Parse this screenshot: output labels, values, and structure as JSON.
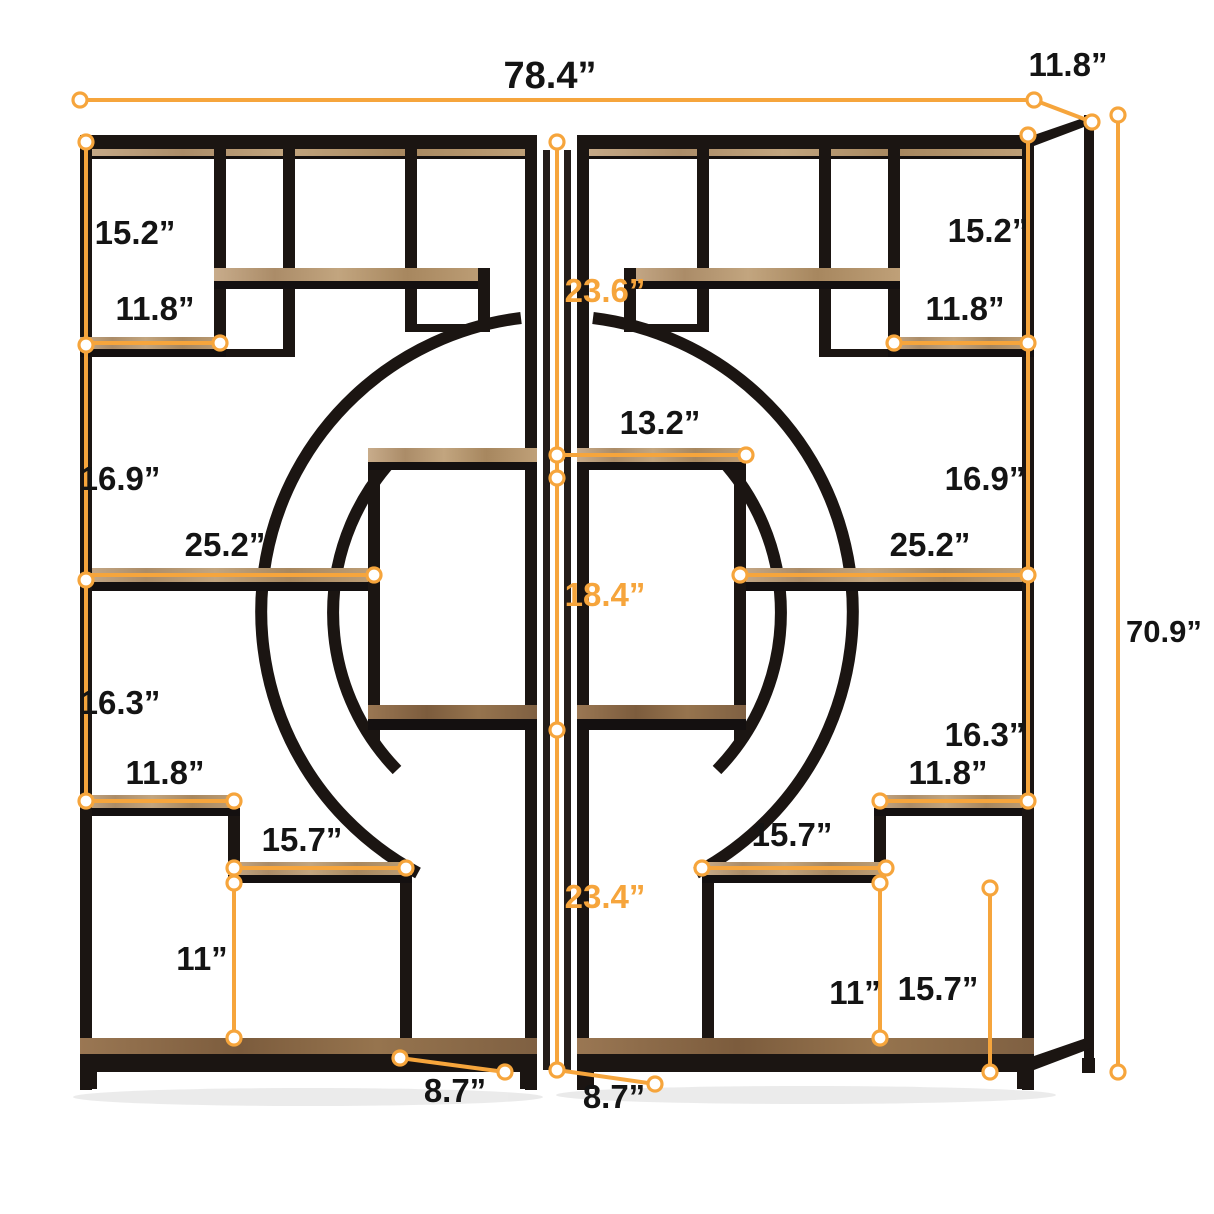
{
  "diagram": {
    "kind": "furniture-dimension-diagram",
    "subject": "double etagere bookshelf with circular arch shelves",
    "background": "#ffffff"
  },
  "colors": {
    "dimension_line": "#F6A53C",
    "dimension_label": "#141414",
    "dimension_label_accent": "#F6A53C",
    "frame_black": "#1b1512",
    "wood_light": "#b49a7d",
    "wood_dark": "#8a6a4b"
  },
  "dimensions": {
    "overall_width": "78.4”",
    "overall_depth": "11.8”",
    "overall_height": "70.9”",
    "left_unit": {
      "top_section_height": "15.2”",
      "top_shelf_width": "11.8”",
      "upper_middle_section_height": "16.9”",
      "middle_shelf_width": "25.2”",
      "lower_middle_section_height": "16.3”",
      "lower_shelf_width": "11.8”",
      "step_shelf_width": "15.7”",
      "step_section_height": "11”",
      "base_depth": "8.7”"
    },
    "center_column": {
      "upper_opening_height": "23.6”",
      "center_shelf_width": "13.2”",
      "middle_opening_height": "18.4”",
      "lower_opening_height": "23.4”"
    },
    "right_unit": {
      "top_section_height": "15.2”",
      "top_shelf_width": "11.8”",
      "upper_middle_section_height": "16.9”",
      "middle_shelf_width": "25.2”",
      "lower_middle_section_height": "16.3”",
      "lower_shelf_width": "11.8”",
      "step_shelf_width": "15.7”",
      "step_section_height": "11”",
      "bottom_section_height": "15.7”",
      "base_depth": "8.7”"
    }
  }
}
